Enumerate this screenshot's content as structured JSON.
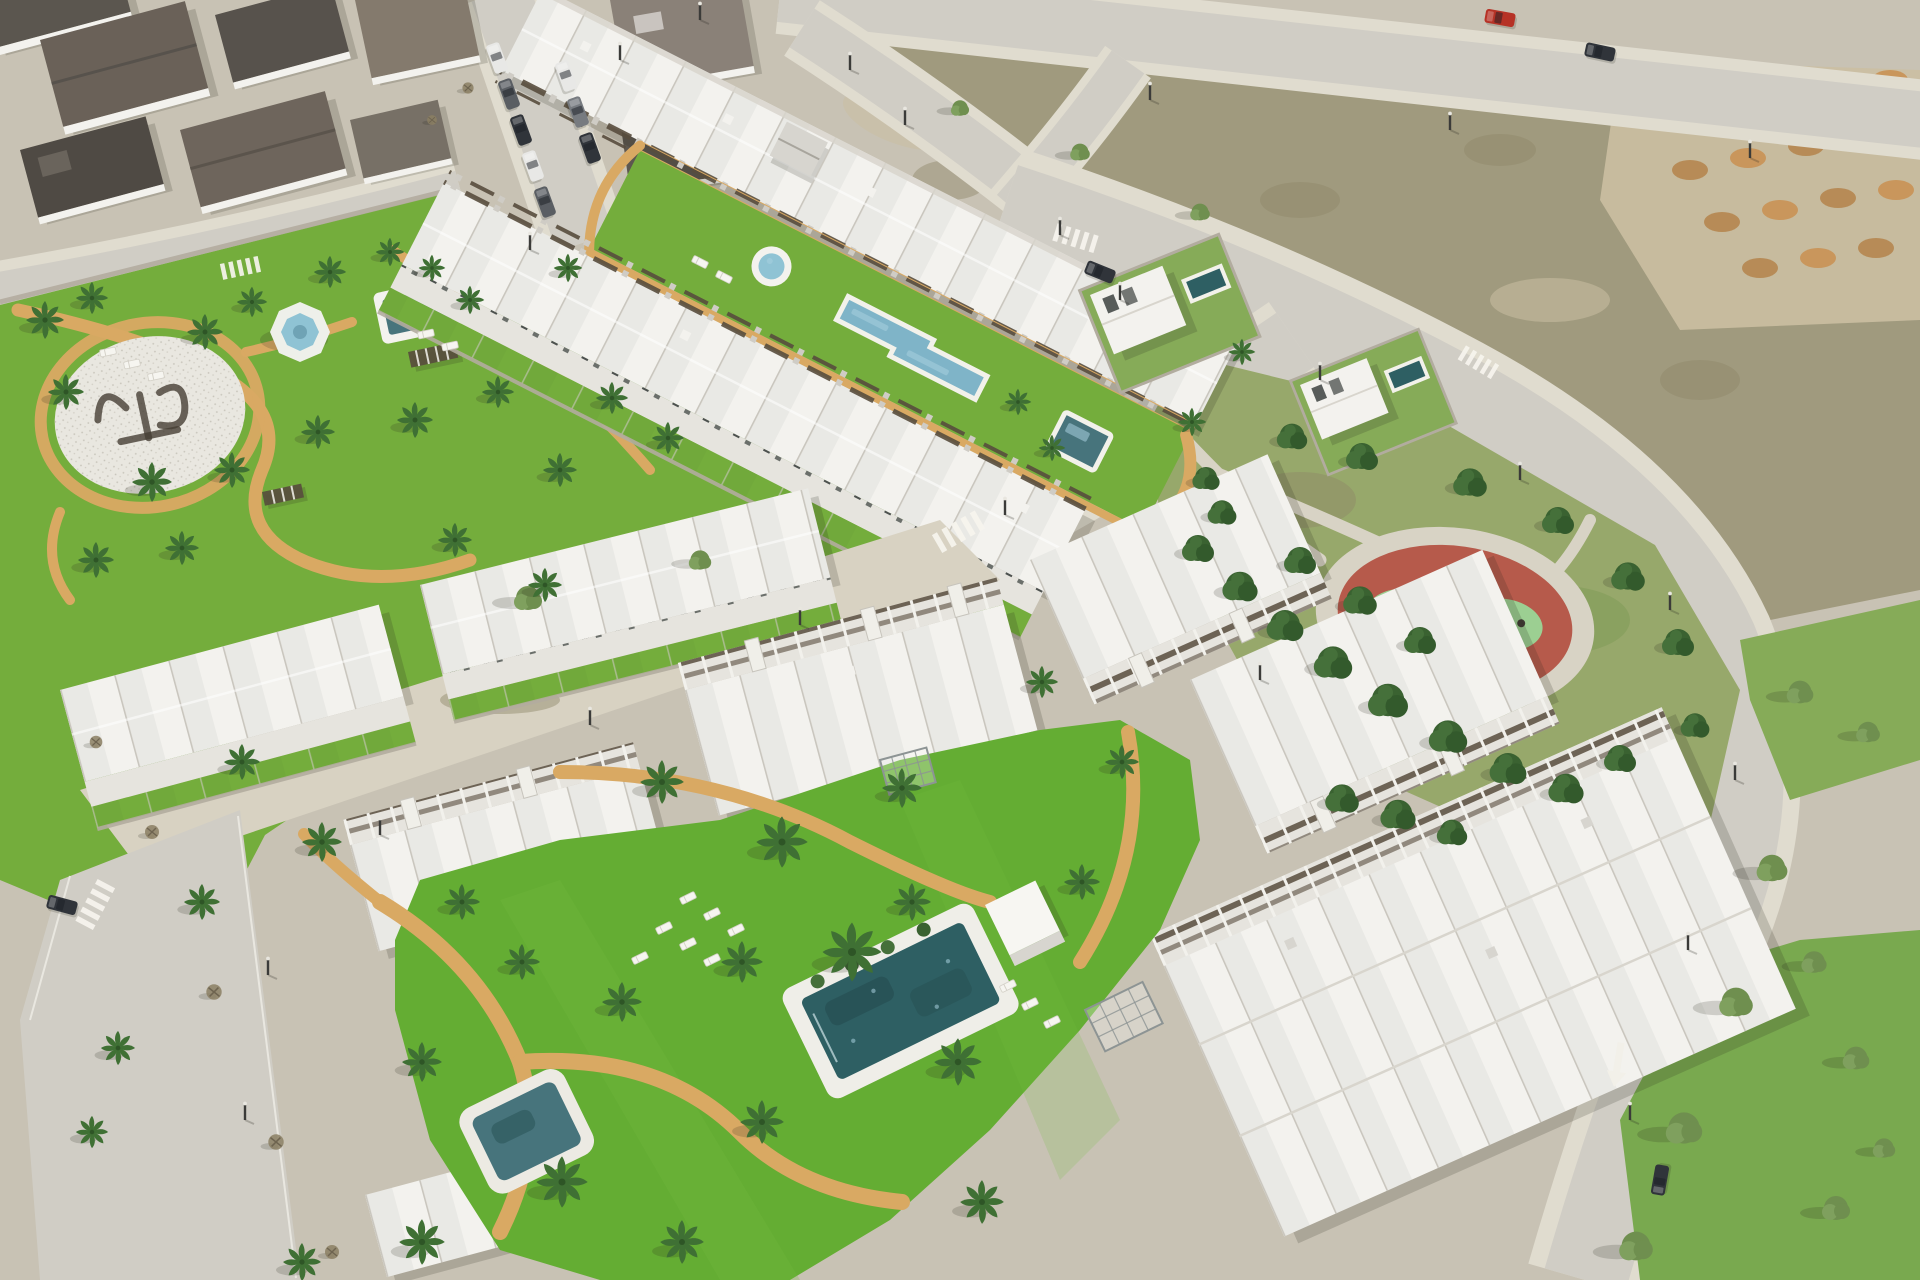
{
  "scene": {
    "description": "Aerial 3D architectural render of a coastal residential development: rows of white townhouses and apartment blocks around communal lawns with swimming pools, a round fountain, palm trees, winding tan paths, a circular ground logo plaza (lettering illegible), bordered by roads, an existing town block, vacant scrub lots with orange dirt mounds, and a public park with a red circular playground among dense green trees.",
    "ground_logo_text": "illegible",
    "road_arrow_direction": "down-left"
  },
  "palette": {
    "ground": "#c8c2b4",
    "road": "#d0cdc5",
    "sidewalk": "#e0dccf",
    "lawn": "#74ad3c",
    "lawn_bright": "#64ad33",
    "lawn_light": "#86ab58",
    "scrub": "#a09a7e",
    "scrub_dark": "#8d8768",
    "sand": "#cbbfa2",
    "dirt_orange": "#c9965c",
    "path_tan": "#d9a963",
    "pool_dark": "#2e5f63",
    "pool_mid": "#47747c",
    "pool_light": "#7fb4c8",
    "fountain": "#8fc3d4",
    "water_sparkle": "#a8d0de",
    "building_white": "#f3f2ee",
    "building_shade": "#e6e4de",
    "building_grey": "#d7d5cf",
    "roof_dark": "#5b564f",
    "roof_brown": "#847a6d",
    "pergola_brown": "#584d3d",
    "window_dark": "#3c423f",
    "wall_stone": "#b2ac9f",
    "tree_dark": "#3a6231",
    "tree_mid": "#45703a",
    "tree_deep": "#335a2c",
    "tree_olive": "#6f8f4f",
    "palm_green": "#3f7034",
    "trunk": "#7a6a4f",
    "playground_red": "#b65a4b",
    "playground_green": "#9ccf92",
    "shadow": "rgba(40,40,30,0.18)",
    "car_red": "#b63226",
    "car_grey": "#5a5e63",
    "car_dark": "#30343a",
    "car_mid": "#777b80",
    "car_white": "#e8e8e6"
  },
  "vegetation": {
    "palms": [
      [
        45,
        320,
        1.0
      ],
      [
        92,
        298,
        0.85
      ],
      [
        66,
        392,
        0.95
      ],
      [
        205,
        332,
        0.95
      ],
      [
        252,
        302,
        0.8
      ],
      [
        330,
        272,
        0.85
      ],
      [
        152,
        482,
        1.05
      ],
      [
        232,
        470,
        0.95
      ],
      [
        318,
        432,
        0.9
      ],
      [
        415,
        420,
        0.95
      ],
      [
        498,
        392,
        0.85
      ],
      [
        96,
        560,
        0.95
      ],
      [
        182,
        548,
        0.9
      ],
      [
        390,
        252,
        0.75
      ],
      [
        470,
        300,
        0.75
      ],
      [
        612,
        398,
        0.85
      ],
      [
        668,
        438,
        0.85
      ],
      [
        560,
        470,
        0.9
      ],
      [
        455,
        540,
        0.9
      ],
      [
        545,
        585,
        0.9
      ],
      [
        568,
        268,
        0.75
      ],
      [
        432,
        268,
        0.7
      ],
      [
        1018,
        402,
        0.7
      ],
      [
        1052,
        448,
        0.7
      ],
      [
        1192,
        422,
        0.75
      ],
      [
        1242,
        352,
        0.7
      ],
      [
        662,
        782,
        1.15
      ],
      [
        782,
        842,
        1.35
      ],
      [
        902,
        788,
        1.05
      ],
      [
        852,
        952,
        1.55
      ],
      [
        958,
        1062,
        1.25
      ],
      [
        762,
        1122,
        1.15
      ],
      [
        622,
        1002,
        1.05
      ],
      [
        562,
        1182,
        1.35
      ],
      [
        682,
        1242,
        1.15
      ],
      [
        462,
        902,
        0.95
      ],
      [
        422,
        1062,
        1.05
      ],
      [
        982,
        1202,
        1.15
      ],
      [
        1082,
        882,
        0.95
      ],
      [
        1122,
        762,
        0.9
      ],
      [
        1042,
        682,
        0.85
      ],
      [
        912,
        902,
        1.0
      ],
      [
        742,
        962,
        1.1
      ],
      [
        522,
        962,
        0.95
      ],
      [
        242,
        762,
        0.95
      ],
      [
        322,
        842,
        1.05
      ],
      [
        202,
        902,
        0.95
      ],
      [
        422,
        1242,
        1.2
      ],
      [
        302,
        1262,
        1.0
      ],
      [
        118,
        1048,
        0.9
      ],
      [
        92,
        1132,
        0.85
      ]
    ],
    "park_trees": [
      [
        1198,
        548,
        1.0
      ],
      [
        1240,
        586,
        1.1
      ],
      [
        1285,
        625,
        1.15
      ],
      [
        1333,
        662,
        1.2
      ],
      [
        1388,
        700,
        1.25
      ],
      [
        1448,
        736,
        1.2
      ],
      [
        1508,
        768,
        1.15
      ],
      [
        1566,
        788,
        1.1
      ],
      [
        1620,
        758,
        1.0
      ],
      [
        1222,
        512,
        0.9
      ],
      [
        1300,
        560,
        1.0
      ],
      [
        1360,
        600,
        1.05
      ],
      [
        1420,
        640,
        1.0
      ],
      [
        1292,
        436,
        0.95
      ],
      [
        1362,
        456,
        1.0
      ],
      [
        1470,
        482,
        1.05
      ],
      [
        1558,
        520,
        1.0
      ],
      [
        1628,
        576,
        1.05
      ],
      [
        1678,
        642,
        1.0
      ],
      [
        1206,
        478,
        0.85
      ],
      [
        1342,
        798,
        1.05
      ],
      [
        1398,
        814,
        1.1
      ],
      [
        1452,
        832,
        0.95
      ],
      [
        1695,
        725,
        0.9
      ]
    ],
    "street_trees": [
      [
        1772,
        868,
        1.1
      ],
      [
        1736,
        1002,
        1.2
      ],
      [
        1684,
        1128,
        1.3
      ],
      [
        1636,
        1246,
        1.2
      ],
      [
        1856,
        1058,
        0.95
      ],
      [
        1836,
        1208,
        1.0
      ],
      [
        1884,
        1148,
        0.8
      ],
      [
        1814,
        962,
        0.9
      ],
      [
        1800,
        692,
        0.95
      ],
      [
        1868,
        732,
        0.85
      ],
      [
        1080,
        152,
        0.7
      ],
      [
        1200,
        212,
        0.7
      ],
      [
        960,
        108,
        0.65
      ],
      [
        528,
        598,
        1.0
      ],
      [
        700,
        560,
        0.8
      ]
    ],
    "bare_trees": [
      [
        152,
        832,
        1.0
      ],
      [
        214,
        992,
        1.1
      ],
      [
        276,
        1142,
        1.1
      ],
      [
        332,
        1252,
        1.0
      ],
      [
        96,
        742,
        0.9
      ],
      [
        468,
        88,
        0.8
      ],
      [
        432,
        120,
        0.7
      ]
    ]
  },
  "furniture": {
    "loungers": [
      [
        688,
        898,
        -26
      ],
      [
        712,
        914,
        -26
      ],
      [
        736,
        930,
        -26
      ],
      [
        664,
        928,
        -26
      ],
      [
        688,
        944,
        -26
      ],
      [
        712,
        960,
        -26
      ],
      [
        640,
        958,
        -26
      ],
      [
        1008,
        986,
        -26
      ],
      [
        1030,
        1004,
        -26
      ],
      [
        1052,
        1022,
        -26
      ],
      [
        108,
        352,
        -12
      ],
      [
        132,
        364,
        -12
      ],
      [
        156,
        376,
        -12
      ],
      [
        426,
        334,
        -12
      ],
      [
        450,
        346,
        -12
      ],
      [
        700,
        262,
        27
      ],
      [
        724,
        277,
        27
      ]
    ],
    "lamps": [
      [
        850,
        70
      ],
      [
        1150,
        100
      ],
      [
        1450,
        130
      ],
      [
        1750,
        158
      ],
      [
        905,
        125
      ],
      [
        1060,
        235
      ],
      [
        1120,
        300
      ],
      [
        1320,
        380
      ],
      [
        1520,
        480
      ],
      [
        1670,
        610
      ],
      [
        1735,
        780
      ],
      [
        1688,
        950
      ],
      [
        1630,
        1120
      ],
      [
        1005,
        515
      ],
      [
        800,
        625
      ],
      [
        590,
        725
      ],
      [
        380,
        835
      ],
      [
        268,
        975
      ],
      [
        245,
        1120
      ],
      [
        530,
        250
      ],
      [
        1260,
        680
      ],
      [
        620,
        60
      ],
      [
        700,
        20
      ]
    ]
  },
  "vehicles": [
    {
      "x": 1500,
      "y": 18,
      "a": 10,
      "c": "car_red"
    },
    {
      "x": 1600,
      "y": 52,
      "a": 12,
      "c": "car_dark"
    },
    {
      "x": 1100,
      "y": 272,
      "a": 22,
      "c": "car_dark"
    },
    {
      "x": 1660,
      "y": 1180,
      "a": -80,
      "c": "car_dark"
    },
    {
      "x": 62,
      "y": 905,
      "a": 15,
      "c": "car_dark"
    },
    {
      "x": 497,
      "y": 58,
      "a": 70,
      "c": "car_white"
    },
    {
      "x": 509,
      "y": 94,
      "a": 70,
      "c": "car_grey"
    },
    {
      "x": 521,
      "y": 130,
      "a": 70,
      "c": "car_dark"
    },
    {
      "x": 533,
      "y": 166,
      "a": 70,
      "c": "car_white"
    },
    {
      "x": 545,
      "y": 202,
      "a": 70,
      "c": "car_grey"
    },
    {
      "x": 566,
      "y": 76,
      "a": 70,
      "c": "car_white"
    },
    {
      "x": 578,
      "y": 112,
      "a": 70,
      "c": "car_mid"
    },
    {
      "x": 590,
      "y": 148,
      "a": 70,
      "c": "car_dark"
    }
  ]
}
